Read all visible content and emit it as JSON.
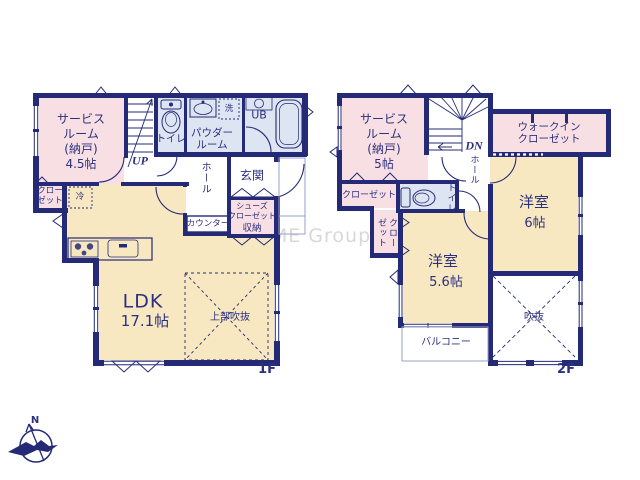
{
  "watermark": "ME Group",
  "compass": {
    "north_label": "N"
  },
  "palette": {
    "wall_navy": "#242a76",
    "text_navy": "#2b3080",
    "room_pink": "#f8dfe3",
    "room_blue": "#dde5f2",
    "room_cream": "#f8e8c2",
    "watermark_gray": "#d8d8da"
  },
  "floor1": {
    "floor_label": "1F",
    "rooms": {
      "service_room": "サービス\nルーム\n(納戸)\n4.5帖",
      "stairs_up": "UP",
      "toilet": "トイレ",
      "powder_room": "パウダー\nルーム",
      "laundry": "洗",
      "unit_bath": "UB",
      "entrance": "玄関",
      "hall": "ホール",
      "closet": "クロー\nゼット",
      "fridge": "冷",
      "counter": "カウンター",
      "shoes_closet": "シューズ\nクローゼット",
      "storage": "収納",
      "ldk_name": "LDK",
      "ldk_size": "17.1帖",
      "void_above": "上部吹抜"
    }
  },
  "floor2": {
    "floor_label": "2F",
    "rooms": {
      "service_room": "サービス\nルーム\n(納戸)\n5帖",
      "stairs_down": "DN",
      "walk_in_closet": "ウォークイン\nクローゼット",
      "hall": "ホール",
      "closet_a": "クローゼット",
      "toilet": "トイレ",
      "closet_b": "クローゼット",
      "bedroom_6_name": "洋室",
      "bedroom_6_size": "6帖",
      "bedroom_56_name": "洋室",
      "bedroom_56_size": "5.6帖",
      "void": "吹抜",
      "balcony": "バルコニー"
    }
  }
}
